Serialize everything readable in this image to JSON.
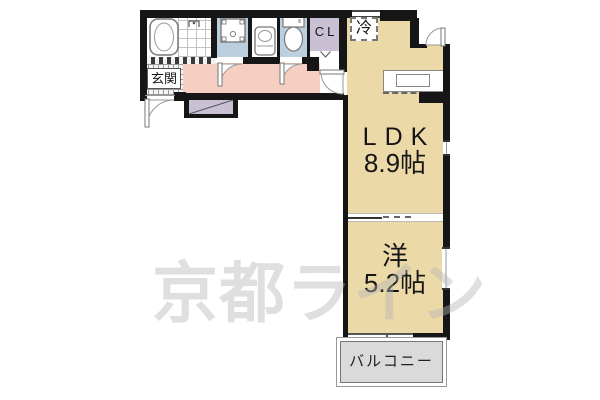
{
  "plan": {
    "watermark_text": "京都ライン",
    "labels": {
      "entrance": "玄関",
      "closet": "CL",
      "refrigerator": "冷",
      "ldk_name": "LDK",
      "ldk_size": "8.9帖",
      "western_name": "洋",
      "western_size": "5.2帖",
      "balcony": "バルコニー"
    },
    "colors": {
      "wall": "#161616",
      "floor_tan": "#EBD9A7",
      "hallway_pink": "#F6CFC3",
      "wet_area_blue": "#BCCFDF",
      "closet_lavender": "#C9C0D4",
      "balcony_gray": "#DADADA",
      "outline_gray": "#888888"
    }
  }
}
